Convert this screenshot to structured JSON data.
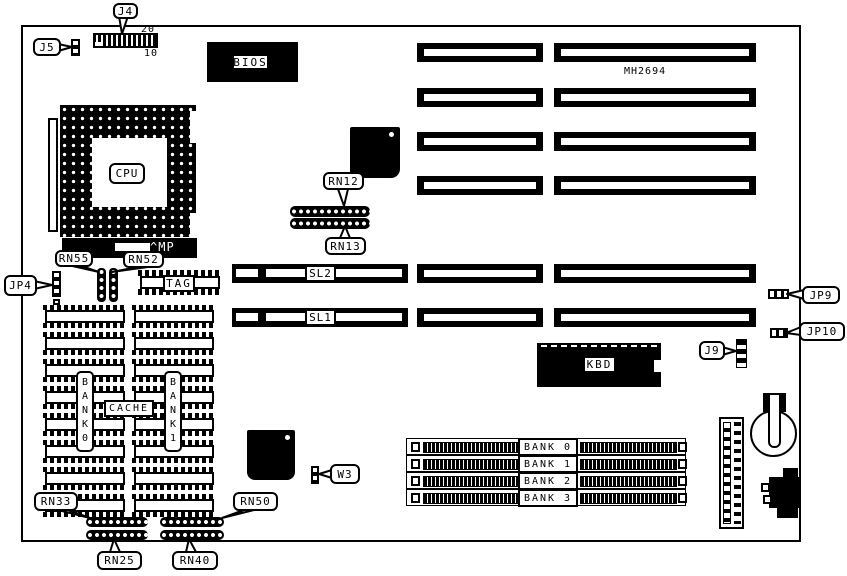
{
  "board": {
    "marking": "MH2694",
    "ink": "#000000",
    "paper": "#ffffff"
  },
  "callouts": {
    "j4": "J4",
    "j5": "J5",
    "jp4": "JP4",
    "rn55": "RN55",
    "rn52": "RN52",
    "mp": "^MP",
    "tag": "TAG",
    "rn12": "RN12",
    "rn13": "RN13",
    "sl2": "SL2",
    "sl1": "SL1",
    "jp9": "JP9",
    "jp10": "JP10",
    "j9": "J9",
    "w3": "W3",
    "rn33": "RN33",
    "rn50": "RN50",
    "rn25": "RN25",
    "rn40": "RN40"
  },
  "chips": {
    "bios": "BIOS",
    "cpu": "CPU",
    "kbd": "KBD"
  },
  "cache": {
    "label": "CACHE",
    "bank0": "BANK0",
    "bank1": "BANK1"
  },
  "j4_pin_numbers": {
    "top": "20",
    "bottom": "10"
  },
  "simm_slots": {
    "banks": [
      "BANK 0",
      "BANK 1",
      "BANK 2",
      "BANK 3"
    ]
  }
}
